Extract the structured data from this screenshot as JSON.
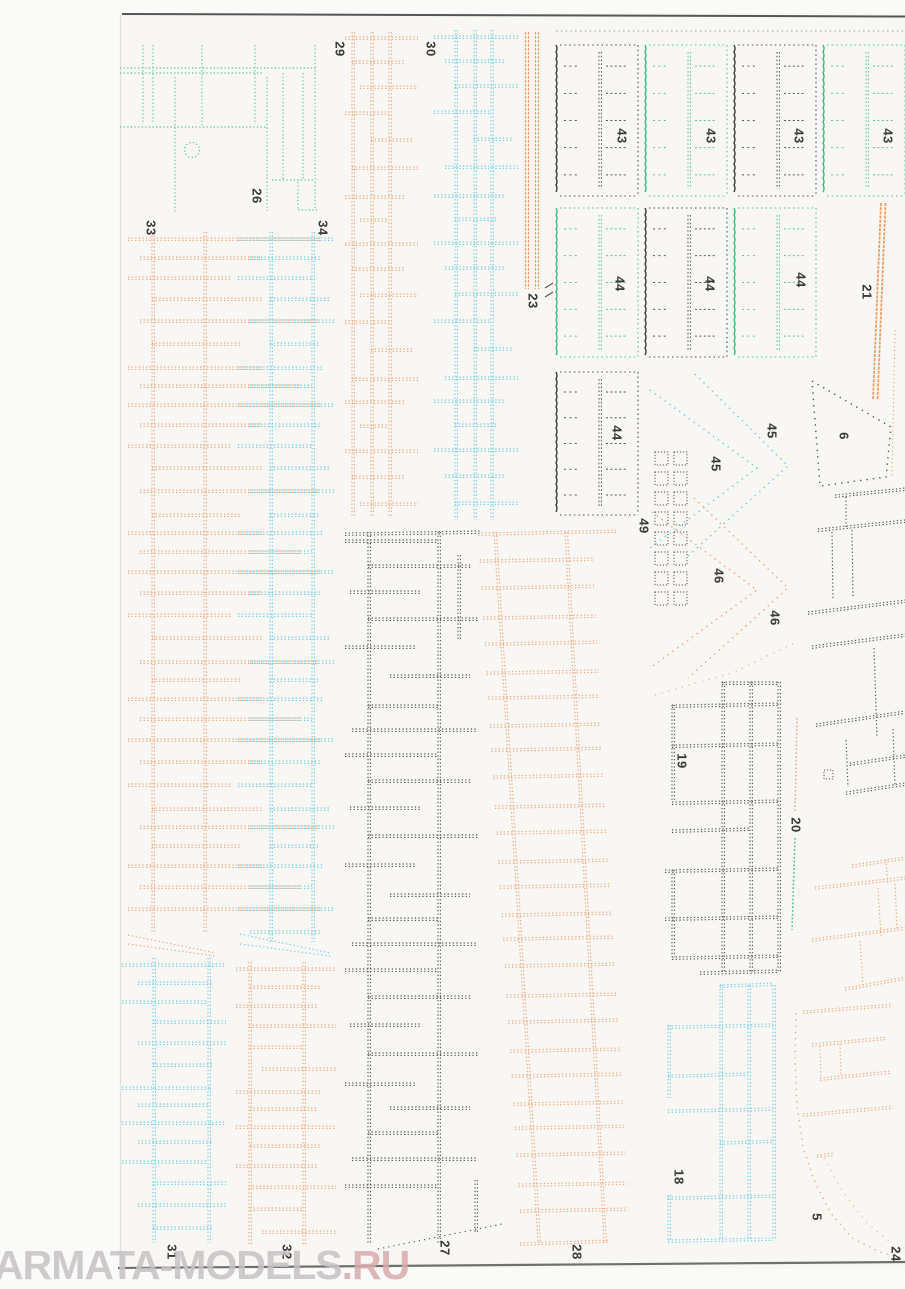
{
  "watermark": {
    "main": "ARMATA-MODELS",
    "suffix": ".RU"
  },
  "colors": {
    "orange": "#f2a57c",
    "orange_dense": "#ee9e6a",
    "cyan": "#6cd0e4",
    "green": "#55c993",
    "green_edge": "#3db97f",
    "teal": "#3fbe8e",
    "dark": "#575757",
    "edge_dark": "#3c3c3c",
    "page_bg": "#f8f7f3",
    "margin_bg": "#fafaf8",
    "top_rule": "#565656",
    "bottom_rule": "#6f6f6f"
  },
  "parts": {
    "5": "5",
    "6": "6",
    "18": "18",
    "19": "19",
    "20": "20",
    "21": "21",
    "23": "23",
    "24": "24",
    "26": "26",
    "27": "27",
    "28": "28",
    "29": "29",
    "30": "30",
    "31": "31",
    "32": "32",
    "33": "33",
    "34": "34",
    "43": "43",
    "44": "44",
    "45": "45",
    "46": "46",
    "49": "49"
  }
}
